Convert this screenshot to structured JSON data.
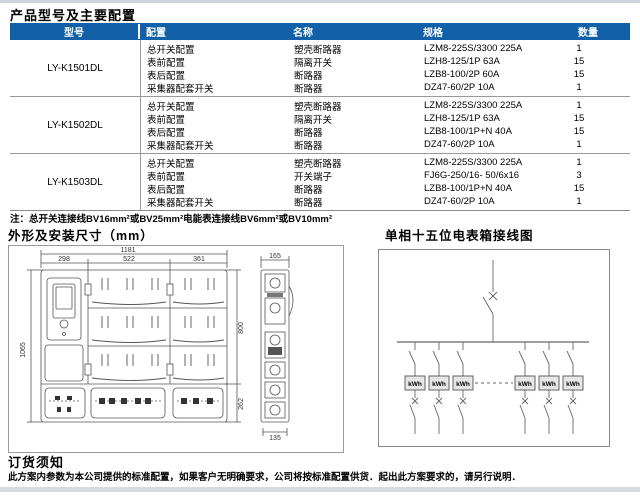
{
  "doc": {
    "title": "产品型号及主要配置"
  },
  "table": {
    "headers": [
      "型号",
      "配置",
      "名称",
      "规格",
      "数量"
    ],
    "header_bg": "#1261a8",
    "groups": [
      {
        "model": "LY-K1501DL",
        "rows": [
          {
            "config": "总开关配置",
            "name": "塑壳断路器",
            "spec": "LZM8-225S/3300 225A",
            "qty": "1"
          },
          {
            "config": "表前配置",
            "name": "隔离开关",
            "spec": "LZH8-125/1P 63A",
            "qty": "15"
          },
          {
            "config": "表后配置",
            "name": "断路器",
            "spec": "LZB8-100/2P 60A",
            "qty": "15"
          },
          {
            "config": "采集器配套开关",
            "name": "断路器",
            "spec": "DZ47-60/2P 10A",
            "qty": "1"
          }
        ]
      },
      {
        "model": "LY-K1502DL",
        "rows": [
          {
            "config": "总开关配置",
            "name": "塑壳断路器",
            "spec": "LZM8-225S/3300 225A",
            "qty": "1"
          },
          {
            "config": "表前配置",
            "name": "隔离开关",
            "spec": "LZH8-125/1P 63A",
            "qty": "15"
          },
          {
            "config": "表后配置",
            "name": "断路器",
            "spec": "LZB8-100/1P+N 40A",
            "qty": "15"
          },
          {
            "config": "采集器配套开关",
            "name": "断路器",
            "spec": "DZ47-60/2P 10A",
            "qty": "1"
          }
        ]
      },
      {
        "model": "LY-K1503DL",
        "rows": [
          {
            "config": "总开关配置",
            "name": "塑壳断路器",
            "spec": "LZM8-225S/3300 225A",
            "qty": "1"
          },
          {
            "config": "表前配置",
            "name": "开关端子",
            "spec": "FJ6G-250/16- 50/6x16",
            "qty": "3"
          },
          {
            "config": "表后配置",
            "name": "断路器",
            "spec": "LZB8-100/1P+N 40A",
            "qty": "15"
          },
          {
            "config": "采集器配套开关",
            "name": "断路器",
            "spec": "DZ47-60/2P 10A",
            "qty": "1"
          }
        ]
      }
    ]
  },
  "note": {
    "text": "注：总开关连接线BV16mm²或BV25mm²电能表连接线BV6mm²或BV10mm²"
  },
  "drawing": {
    "title": "外形及安装尺寸（mm）",
    "dims": {
      "total_width": "1181",
      "col_left": "298",
      "col_middle": "522",
      "col_right": "361",
      "height_total": "1065",
      "height_upper": "800",
      "height_lower": "262",
      "side_width": "165",
      "side_bottom_width": "135"
    }
  },
  "wiring": {
    "title": "单相十五位电表箱接线图",
    "meter_label": "kWh"
  },
  "ordering": {
    "title": "订货须知",
    "text": "此方案内参数为本公司提供的标准配置，如果客户无明确要求，公司将按标准配置供货．起出此方案要求的，请另行说明．"
  }
}
